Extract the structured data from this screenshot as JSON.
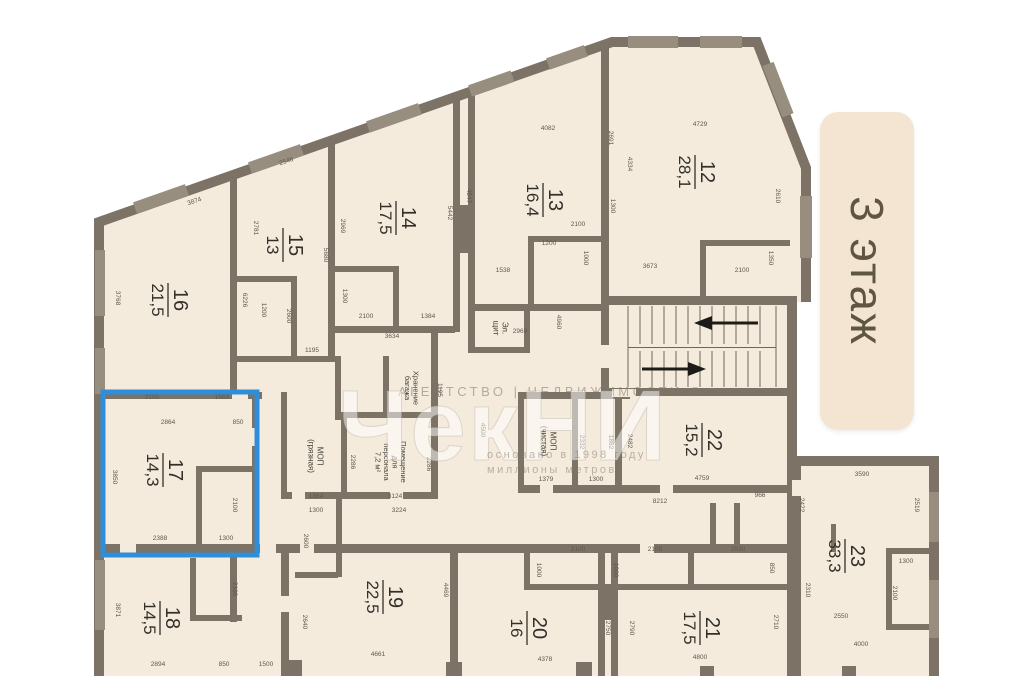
{
  "floor_label": "3 этаж",
  "watermark": {
    "line1": "АГЕНТСТВО | НЕДВИЖИМОСТИ ®",
    "big": "ЧекНИ",
    "line2": "основано в 1998 году",
    "line3": "миллионы метров"
  },
  "colors": {
    "wall": "#7c7366",
    "window": "#978e7f",
    "room_fill": "#f4ebdc",
    "highlight": "#2f8ed8",
    "badge_bg": "#f3e5d2",
    "badge_text": "#5f5640",
    "dim_text": "#5d584e",
    "label_text": "#33302a",
    "watermark": "#7d766a"
  },
  "highlight": {
    "room": "17",
    "x": 103,
    "y": 392,
    "w": 154,
    "h": 163
  },
  "rooms": [
    {
      "number": "16",
      "area": "21,5",
      "x": 168,
      "y": 300,
      "highlighted": false
    },
    {
      "number": "15",
      "area": "13",
      "x": 283,
      "y": 245,
      "highlighted": false
    },
    {
      "number": "14",
      "area": "17,5",
      "x": 396,
      "y": 218,
      "highlighted": false
    },
    {
      "number": "13",
      "area": "16,4",
      "x": 543,
      "y": 200,
      "highlighted": false
    },
    {
      "number": "12",
      "area": "28,1",
      "x": 695,
      "y": 172,
      "highlighted": false
    },
    {
      "number": "17",
      "area": "14,3",
      "x": 163,
      "y": 470,
      "highlighted": true
    },
    {
      "number": "22",
      "area": "15,2",
      "x": 702,
      "y": 440,
      "highlighted": false
    },
    {
      "number": "18",
      "area": "14,5",
      "x": 160,
      "y": 618,
      "highlighted": false
    },
    {
      "number": "19",
      "area": "22,5",
      "x": 383,
      "y": 597,
      "highlighted": false
    },
    {
      "number": "20",
      "area": "16",
      "x": 527,
      "y": 628,
      "highlighted": false
    },
    {
      "number": "21",
      "area": "17,5",
      "x": 700,
      "y": 628,
      "highlighted": false
    },
    {
      "number": "23",
      "area": "33,3",
      "x": 845,
      "y": 556,
      "highlighted": false
    }
  ],
  "service_rooms": [
    {
      "lines": [
        "Эл.",
        "щит"
      ],
      "x": 498,
      "y": 328,
      "fs": 8
    },
    {
      "lines": [
        "МОП",
        "(грязная)"
      ],
      "x": 313,
      "y": 456,
      "fs": 8
    },
    {
      "lines": [
        "Помещение",
        "для",
        "персонала",
        "7,2 м²"
      ],
      "x": 388,
      "y": 462,
      "fs": 7.5
    },
    {
      "lines": [
        "Хранение",
        "багажа"
      ],
      "x": 409,
      "y": 388,
      "fs": 7.5
    },
    {
      "lines": [
        "МОП",
        "(чистая)"
      ],
      "x": 546,
      "y": 441,
      "fs": 8
    }
  ],
  "stairs": {
    "treads_upper": 11,
    "treads_lower": 11,
    "arrow_upper": "left",
    "arrow_lower": "right"
  },
  "dimensions_mm": [
    {
      "t": "3874",
      "x": 195,
      "y": 203,
      "r": -19
    },
    {
      "t": "3768",
      "x": 116,
      "y": 298,
      "r": 90
    },
    {
      "t": "6226",
      "x": 243,
      "y": 300,
      "r": 90
    },
    {
      "t": "2546",
      "x": 287,
      "y": 163,
      "r": -19
    },
    {
      "t": "2781",
      "x": 254,
      "y": 228,
      "r": 90
    },
    {
      "t": "5680",
      "x": 324,
      "y": 255,
      "r": 90
    },
    {
      "t": "1200",
      "x": 262,
      "y": 310,
      "r": 90
    },
    {
      "t": "2600",
      "x": 287,
      "y": 316,
      "r": 90
    },
    {
      "t": "1195",
      "x": 312,
      "y": 352,
      "r": 0
    },
    {
      "t": "2969",
      "x": 341,
      "y": 226,
      "r": 90
    },
    {
      "t": "5442",
      "x": 448,
      "y": 213,
      "r": 90
    },
    {
      "t": "1300",
      "x": 343,
      "y": 296,
      "r": 90
    },
    {
      "t": "2100",
      "x": 366,
      "y": 318,
      "r": 0
    },
    {
      "t": "1384",
      "x": 428,
      "y": 318,
      "r": 0
    },
    {
      "t": "3634",
      "x": 392,
      "y": 338,
      "r": 0
    },
    {
      "t": "4082",
      "x": 548,
      "y": 130,
      "r": 0
    },
    {
      "t": "4547",
      "x": 467,
      "y": 196,
      "r": 90
    },
    {
      "t": "2691",
      "x": 609,
      "y": 138,
      "r": 90
    },
    {
      "t": "2100",
      "x": 578,
      "y": 226,
      "r": 0
    },
    {
      "t": "1300",
      "x": 611,
      "y": 206,
      "r": 90
    },
    {
      "t": "1200",
      "x": 549,
      "y": 245,
      "r": 0
    },
    {
      "t": "1000",
      "x": 584,
      "y": 258,
      "r": 90
    },
    {
      "t": "1538",
      "x": 503,
      "y": 272,
      "r": 0
    },
    {
      "t": "2969",
      "x": 520,
      "y": 333,
      "r": 0
    },
    {
      "t": "4960",
      "x": 557,
      "y": 322,
      "r": 90
    },
    {
      "t": "4729",
      "x": 700,
      "y": 126,
      "r": 0
    },
    {
      "t": "4334",
      "x": 628,
      "y": 164,
      "r": 90
    },
    {
      "t": "3673",
      "x": 650,
      "y": 268,
      "r": 0
    },
    {
      "t": "2100",
      "x": 742,
      "y": 272,
      "r": 0
    },
    {
      "t": "2610",
      "x": 776,
      "y": 196,
      "r": 90
    },
    {
      "t": "1350",
      "x": 769,
      "y": 258,
      "r": 90
    },
    {
      "t": "2100",
      "x": 152,
      "y": 399,
      "r": 0
    },
    {
      "t": "1563",
      "x": 222,
      "y": 399,
      "r": 0
    },
    {
      "t": "2864",
      "x": 168,
      "y": 424,
      "r": 0
    },
    {
      "t": "850",
      "x": 238,
      "y": 424,
      "r": 0
    },
    {
      "t": "3850",
      "x": 113,
      "y": 477,
      "r": 90
    },
    {
      "t": "2100",
      "x": 233,
      "y": 505,
      "r": 90
    },
    {
      "t": "2388",
      "x": 160,
      "y": 540,
      "r": 0
    },
    {
      "t": "1300",
      "x": 226,
      "y": 540,
      "r": 0
    },
    {
      "t": "1195",
      "x": 438,
      "y": 390,
      "r": 90
    },
    {
      "t": "2286",
      "x": 351,
      "y": 462,
      "r": 90
    },
    {
      "t": "2286",
      "x": 427,
      "y": 464,
      "r": 90
    },
    {
      "t": "1364",
      "x": 316,
      "y": 498,
      "r": 0
    },
    {
      "t": "3124",
      "x": 395,
      "y": 498,
      "r": 0
    },
    {
      "t": "4500",
      "x": 481,
      "y": 430,
      "r": 90
    },
    {
      "t": "1379",
      "x": 546,
      "y": 481,
      "r": 0
    },
    {
      "t": "1300",
      "x": 596,
      "y": 481,
      "r": 0
    },
    {
      "t": "2332",
      "x": 580,
      "y": 442,
      "r": 90
    },
    {
      "t": "1862",
      "x": 609,
      "y": 442,
      "r": 90
    },
    {
      "t": "2482",
      "x": 628,
      "y": 441,
      "r": 90
    },
    {
      "t": "4759",
      "x": 702,
      "y": 480,
      "r": 0
    },
    {
      "t": "966",
      "x": 760,
      "y": 497,
      "r": 0
    },
    {
      "t": "8212",
      "x": 660,
      "y": 503,
      "r": 0
    },
    {
      "t": "3871",
      "x": 116,
      "y": 610,
      "r": 90
    },
    {
      "t": "2100",
      "x": 233,
      "y": 589,
      "r": 90
    },
    {
      "t": "2894",
      "x": 158,
      "y": 666,
      "r": 0
    },
    {
      "t": "850",
      "x": 224,
      "y": 666,
      "r": 0
    },
    {
      "t": "1500",
      "x": 266,
      "y": 666,
      "r": 0
    },
    {
      "t": "1300",
      "x": 316,
      "y": 512,
      "r": 0
    },
    {
      "t": "3224",
      "x": 399,
      "y": 512,
      "r": 0
    },
    {
      "t": "2600",
      "x": 304,
      "y": 541,
      "r": 90
    },
    {
      "t": "2640",
      "x": 303,
      "y": 622,
      "r": 90
    },
    {
      "t": "4661",
      "x": 378,
      "y": 656,
      "r": 0
    },
    {
      "t": "4469",
      "x": 444,
      "y": 590,
      "r": 90
    },
    {
      "t": "2100",
      "x": 578,
      "y": 551,
      "r": 0
    },
    {
      "t": "2100",
      "x": 655,
      "y": 551,
      "r": 0
    },
    {
      "t": "2530",
      "x": 738,
      "y": 551,
      "r": 0
    },
    {
      "t": "1000",
      "x": 537,
      "y": 570,
      "r": 90
    },
    {
      "t": "1000",
      "x": 614,
      "y": 570,
      "r": 90
    },
    {
      "t": "850",
      "x": 770,
      "y": 568,
      "r": 90
    },
    {
      "t": "2750",
      "x": 606,
      "y": 628,
      "r": 90
    },
    {
      "t": "2790",
      "x": 630,
      "y": 628,
      "r": 90
    },
    {
      "t": "4378",
      "x": 545,
      "y": 661,
      "r": 0
    },
    {
      "t": "4800",
      "x": 700,
      "y": 659,
      "r": 0
    },
    {
      "t": "2710",
      "x": 774,
      "y": 622,
      "r": 90
    },
    {
      "t": "3590",
      "x": 862,
      "y": 476,
      "r": 0
    },
    {
      "t": "2422",
      "x": 800,
      "y": 505,
      "r": 90
    },
    {
      "t": "2519",
      "x": 915,
      "y": 505,
      "r": 90
    },
    {
      "t": "1300",
      "x": 906,
      "y": 563,
      "r": 0
    },
    {
      "t": "2100",
      "x": 893,
      "y": 593,
      "r": 90
    },
    {
      "t": "2310",
      "x": 806,
      "y": 590,
      "r": 90
    },
    {
      "t": "2550",
      "x": 841,
      "y": 618,
      "r": 0
    },
    {
      "t": "4000",
      "x": 861,
      "y": 646,
      "r": 0
    }
  ]
}
